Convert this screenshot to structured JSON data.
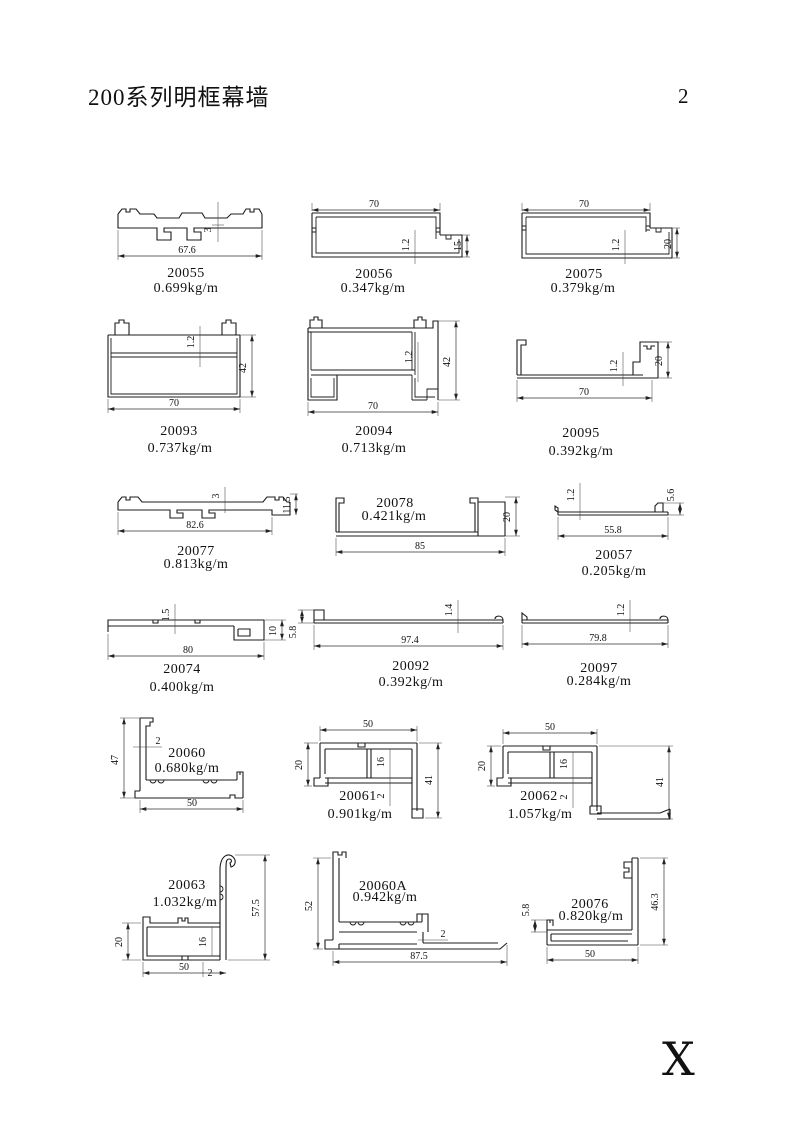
{
  "page": {
    "title": "200系列明框幕墙",
    "page_number": "2",
    "corner_mark": "X"
  },
  "profiles": [
    {
      "code": "20055",
      "weight": "0.699kg/m",
      "dims": {
        "width": "67.6",
        "thickness": "3"
      }
    },
    {
      "code": "20056",
      "weight": "0.347kg/m",
      "dims": {
        "width": "70",
        "wall": "1.2",
        "height": "15"
      }
    },
    {
      "code": "20075",
      "weight": "0.379kg/m",
      "dims": {
        "width": "70",
        "wall": "1.2",
        "height": "20"
      }
    },
    {
      "code": "20093",
      "weight": "0.737kg/m",
      "dims": {
        "width": "70",
        "wall": "1.2",
        "height": "42"
      }
    },
    {
      "code": "20094",
      "weight": "0.713kg/m",
      "dims": {
        "width": "70",
        "wall": "1.2",
        "height": "42"
      }
    },
    {
      "code": "20095",
      "weight": "0.392kg/m",
      "dims": {
        "width": "70",
        "wall": "1.2",
        "height": "20"
      }
    },
    {
      "code": "20077",
      "weight": "0.813kg/m",
      "dims": {
        "width": "82.6",
        "thickness": "3",
        "height": "11.5"
      }
    },
    {
      "code": "20078",
      "weight": "0.421kg/m",
      "dims": {
        "width": "85",
        "height": "20"
      }
    },
    {
      "code": "20057",
      "weight": "0.205kg/m",
      "dims": {
        "width": "55.8",
        "wall": "1.2",
        "height": "5.6"
      }
    },
    {
      "code": "20074",
      "weight": "0.400kg/m",
      "dims": {
        "width": "80",
        "wall": "1.5",
        "height": "10"
      }
    },
    {
      "code": "20092",
      "weight": "0.392kg/m",
      "dims": {
        "width": "97.4",
        "wall": "1.4",
        "height": "5.8"
      }
    },
    {
      "code": "20097",
      "weight": "0.284kg/m",
      "dims": {
        "width": "79.8",
        "wall": "1.2"
      }
    },
    {
      "code": "20060",
      "weight": "0.680kg/m",
      "dims": {
        "height": "47",
        "wall": "2",
        "width": "50"
      }
    },
    {
      "code": "20061",
      "weight": "0.901kg/m",
      "dims": {
        "width": "50",
        "left": "20",
        "inner": "16",
        "wall": "2",
        "right": "41"
      }
    },
    {
      "code": "20062",
      "weight": "1.057kg/m",
      "dims": {
        "width": "50",
        "left": "20",
        "inner": "16",
        "wall": "2",
        "right": "41"
      }
    },
    {
      "code": "20063",
      "weight": "1.032kg/m",
      "dims": {
        "left": "20",
        "inner": "16",
        "right": "57.5",
        "width": "50",
        "wall": "2"
      }
    },
    {
      "code": "20060A",
      "weight": "0.942kg/m",
      "dims": {
        "left": "52",
        "wall": "2",
        "width": "87.5"
      }
    },
    {
      "code": "20076",
      "weight": "0.820kg/m",
      "dims": {
        "left": "5.8",
        "right": "46.3",
        "width": "50"
      }
    }
  ]
}
